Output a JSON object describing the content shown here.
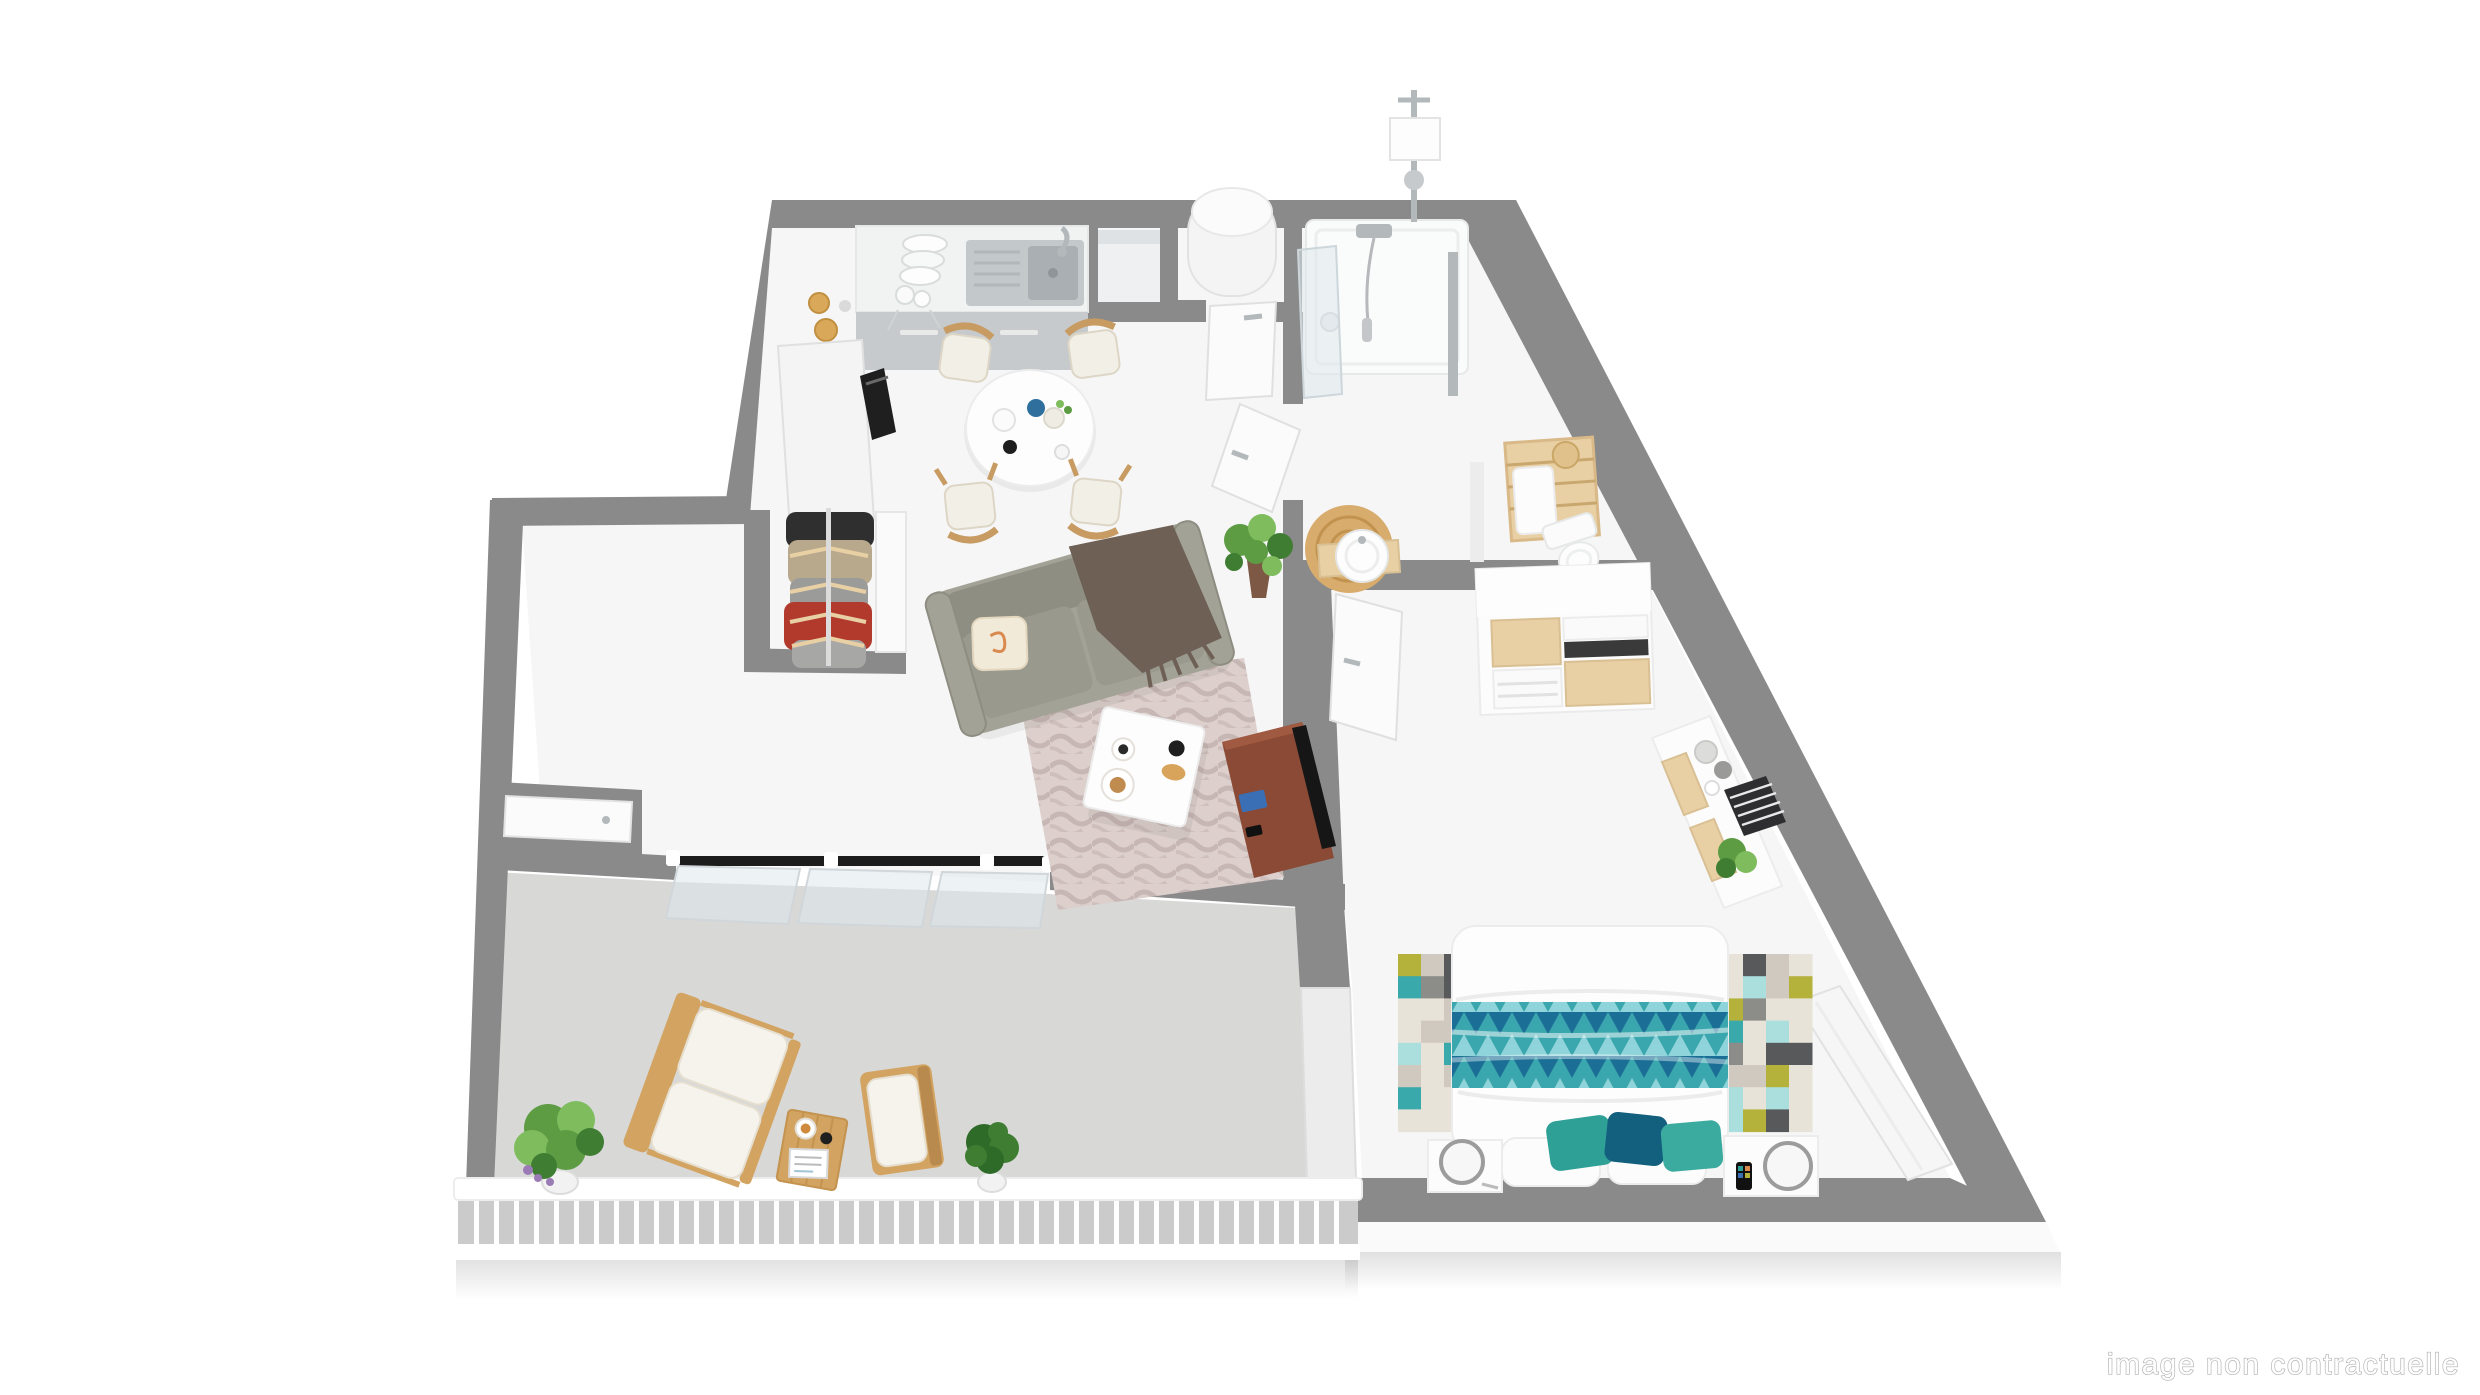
{
  "watermark": {
    "text": "image non contractuelle"
  },
  "scene": {
    "type": "3d-floorplan-render",
    "rooms": [
      "kitchen",
      "dining-area",
      "living-room",
      "entry-hall",
      "closet",
      "hallway",
      "utility-closet",
      "bathroom",
      "wc-basin-nook",
      "bedroom",
      "balcony"
    ],
    "furniture": [
      "kitchen-counter",
      "kitchen-sink",
      "dish-rack",
      "tall-cabinet",
      "oven",
      "dining-table",
      "dining-chairs",
      "hanging-clothes",
      "sofa",
      "throw-blanket",
      "cushion",
      "coffee-table",
      "living-rug",
      "tv-stand",
      "tv",
      "potted-plant",
      "water-heater",
      "shower",
      "shower-fixture",
      "glass-panel",
      "towel-shelf",
      "toilet",
      "round-basin",
      "jute-rug",
      "dresser",
      "sideboard",
      "striped-box",
      "radiator",
      "double-bed",
      "triangle-blanket",
      "pixel-rug",
      "nightstands",
      "round-lamps",
      "smartphone",
      "balcony-loveseat",
      "balcony-armchair",
      "balcony-side-table",
      "coffee-cup",
      "magazine",
      "potted-plants",
      "railing",
      "sliding-bay-window",
      "doors"
    ]
  },
  "colors": {
    "wall": "#8a8a8a",
    "wall_face": "#ececec",
    "floor": "#f6f6f7",
    "balcony_floor": "#d8d8d7",
    "railing": "#ffffff",
    "railing_gap": "#cbcbcb",
    "slab": "#fafafa",
    "rail_dark": "#1c1c1c",
    "counter_top": "#f1f2f2",
    "counter_front": "#c6cacc",
    "sink": "#c3c8ca",
    "sink_inner": "#a9afb3",
    "chrome": "#b3b8bb",
    "oven": "#1f1f1f",
    "jar": "#d9a858",
    "wood": "#c79b62",
    "wood_light": "#e8d0a4",
    "wood_balcony": "#d2a361",
    "wood_dark": "#b98a4e",
    "table": "#fdfdfd",
    "chair_cushion": "#f2efe7",
    "sofa": "#a3a296",
    "sofa_seat": "#9a998d",
    "sofa_back": "#8f8e82",
    "pillow": "#f2ead9",
    "pillow_spiral": "#d98a4e",
    "throw": "#6e6055",
    "rug_pink": "#dccfcc",
    "rug_pink_pattern": "#b9a7a4",
    "tv_stand": "#8a4a36",
    "tv": "#161616",
    "magazine": "#3b6fb5",
    "plant": "#5d9c43",
    "plant_light": "#7fbc5d",
    "plant_dark": "#3f7d33",
    "plant_bush": "#2f6b28",
    "pot": "#f2f2f2",
    "pot_brown": "#7d5844",
    "lavender": "#9a7bb5",
    "door": "#fbfbfb",
    "door_edge": "#dcdcdc",
    "glass": "rgba(223,231,236,0.55)",
    "glass_edge": "#cdd6da",
    "heater": "#f4f4f4",
    "jute": "#d8ac6d",
    "jute_ring": "#c2924f",
    "shirt_dark": "#2f2f2f",
    "shirt_khaki": "#b9a98c",
    "shirt_gray": "#9b9b99",
    "shirt_red": "#b23a2c",
    "shirt_light": "#a7a7a5",
    "dresser": "#fcfcfc",
    "slot_dark": "#3a3a3a",
    "vase_gray": "#9a9a98",
    "box_dark": "#2e2e30",
    "duvet": "#fdfdfd",
    "headboard": "#9c9c9c",
    "blanket_dark": "#1b6f96",
    "blanket_mid": "#3aa6ad",
    "blanket_light": "#8fd4da",
    "cushion_teal": "#2fa096",
    "cushion_dark": "#135f7e",
    "cushion_teal2": "#3cab9f",
    "rug_palette": [
      "#e8e3d9",
      "#cfc9bf",
      "#58595b",
      "#3aa9ab",
      "#b4b23a",
      "#aadfdd",
      "#8c8c88"
    ],
    "watermark_fill": "#ffffff",
    "watermark_stroke": "#b0b0b0"
  }
}
